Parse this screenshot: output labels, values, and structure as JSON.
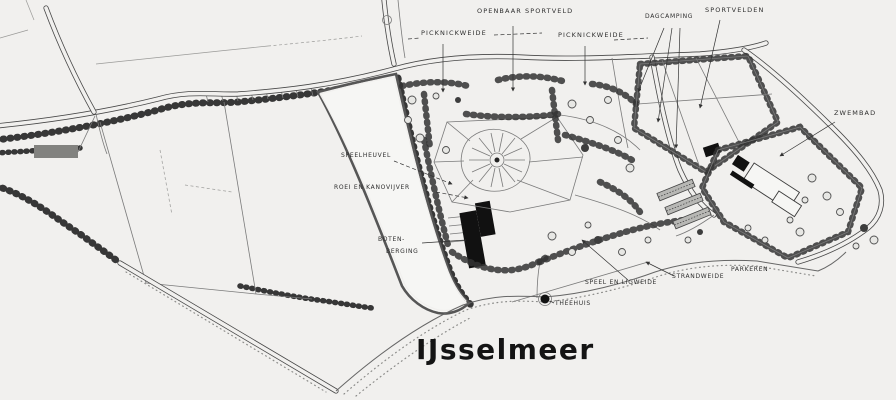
{
  "map": {
    "title": "IJsselmeer",
    "labels": {
      "picknickweide_left": "PICKNICKWEIDE",
      "openbaar_sportveld": "OPENBAAR SPORTVELD",
      "picknickweide_right": "PICKNICKWEIDE",
      "dagcamping": "DAGCAMPING",
      "sportvelden": "SPORTVELDEN",
      "zwembad": "ZWEMBAD",
      "speelheuvel": "SPEELHEUVEL",
      "roei_en_kanovijver": "ROEI EN KANOVIJVER",
      "boten_berging_top": "BOTEN-",
      "boten_berging_bottom": "BERGING",
      "speel_en_ligweide": "SPEEL EN LIGWEIDE",
      "strandweide": "STRANDWEIDE",
      "parkeren": "PARKEREN",
      "theehuis": "THEEHUIS"
    },
    "colors": {
      "paper": "#f1f0ee",
      "ink": "#3c3c3c",
      "dark_planting": "#272727",
      "building": "#111111",
      "title_ink": "#141414"
    }
  }
}
